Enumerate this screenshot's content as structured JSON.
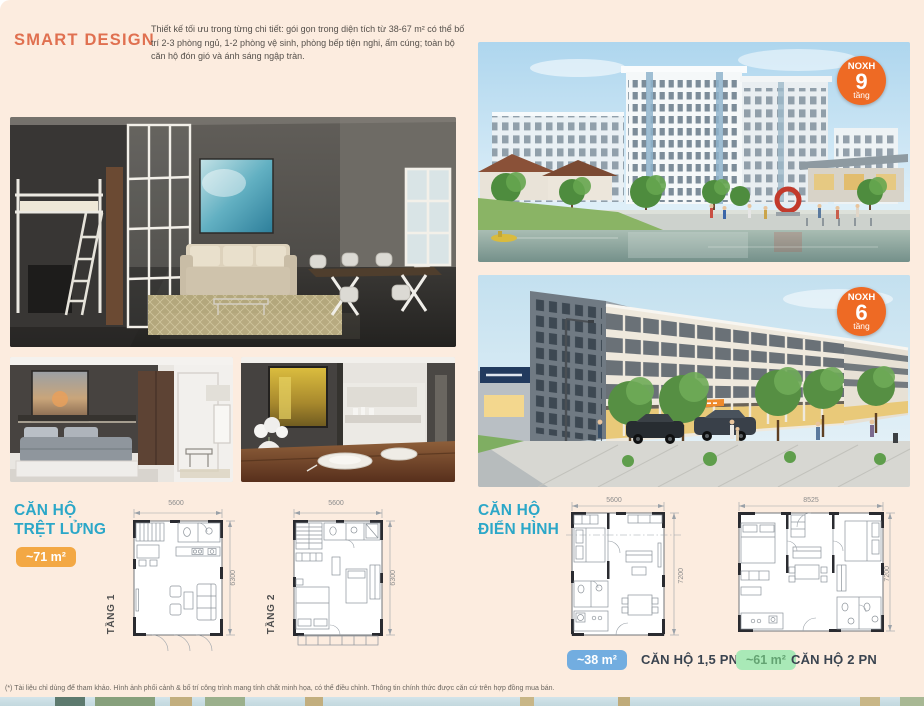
{
  "colors": {
    "page_bg": "#fcecdf",
    "accent_orange": "#e07050",
    "accent_teal": "#2ba7c8",
    "badge_orange": "#f3a844",
    "badge_blue": "#72ade0",
    "badge_green": "#a9e9b7",
    "noxh_badge": "#ee6a24"
  },
  "header": {
    "title": "SMART DESIGN",
    "description": "Thiết kế tối ưu trong từng chi tiết: gói gọn trong diện tích từ 38-67 m² có thể bố trí 2-3 phòng ngủ, 1-2 phòng vệ sinh, phòng bếp tiện nghi, ấm cúng; toàn bộ căn hộ đón gió và ánh sáng ngập tràn."
  },
  "renders": {
    "building9_badge": {
      "prefix": "NOXH",
      "number": "9",
      "unit": "tầng"
    },
    "building6_badge": {
      "prefix": "NOXH",
      "number": "6",
      "unit": "tầng"
    }
  },
  "loft_section": {
    "title_line1": "CĂN HỘ",
    "title_line2": "TRỆT LỬNG",
    "area_badge": "~71 m²",
    "plans": [
      {
        "label": "TẦNG 1",
        "width_dim": "5600",
        "height_dim": "6300"
      },
      {
        "label": "TẦNG 2",
        "width_dim": "5600",
        "height_dim": "6300"
      }
    ]
  },
  "typical_section": {
    "title_line1": "CĂN HỘ",
    "title_line2": "ĐIỂN HÌNH",
    "plans": [
      {
        "area_badge": "~38 m²",
        "name": "CĂN HỘ 1,5 PN",
        "width_dim": "5600",
        "height_dim": "7200"
      },
      {
        "area_badge": "~61 m²",
        "name": "CĂN HỘ 2 PN",
        "width_dim": "8525",
        "height_dim": "7200"
      }
    ]
  },
  "footnote": "(*) Tài liệu chỉ dùng để tham khảo. Hình ảnh phối cảnh & bố trí công trình mang tính chất minh họa, có thể điều chỉnh. Thông tin chính thức được căn cứ trên hợp đồng mua bán."
}
